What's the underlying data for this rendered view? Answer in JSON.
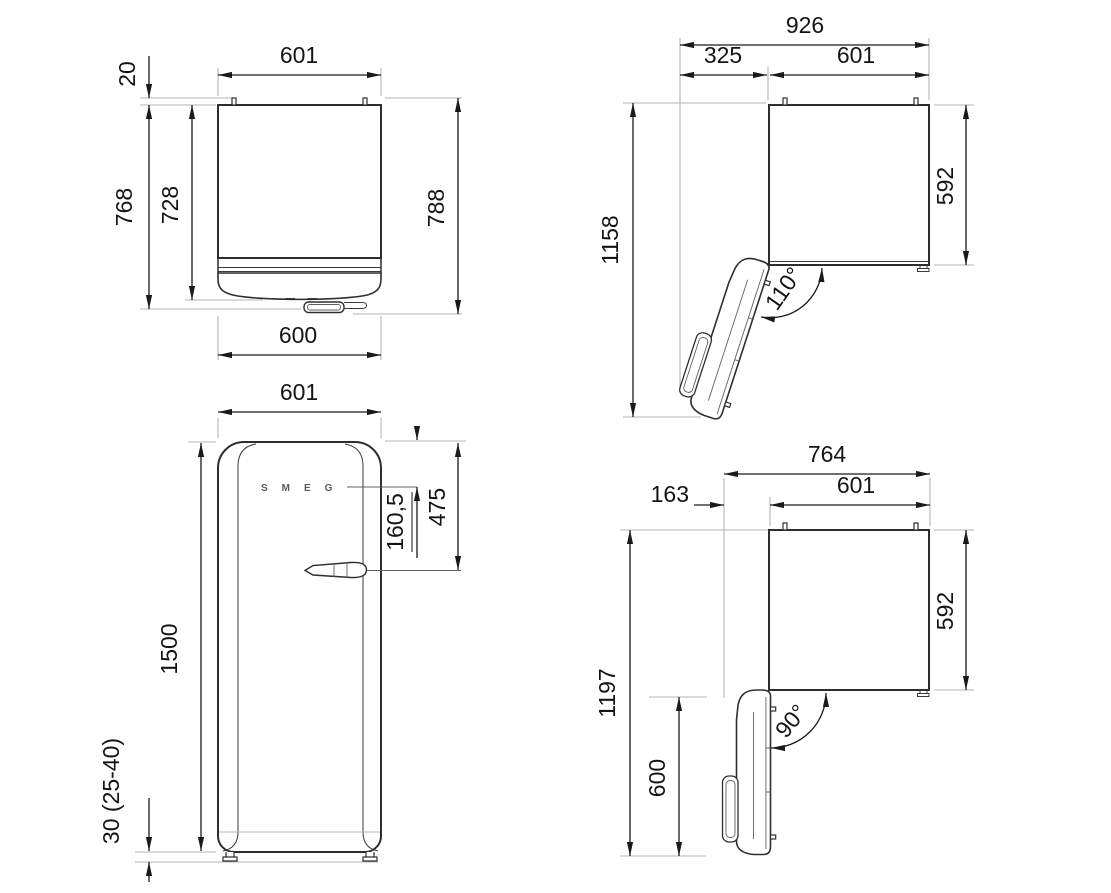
{
  "title": "refrigerator-dimension-drawing",
  "colors": {
    "dimension": "#1a1a1a",
    "extension": "#b4b4b4",
    "outline": "#2e2e2e",
    "detail": "#606060",
    "background": "#ffffff"
  },
  "views": {
    "top_closed": {
      "name": "Top view, door closed",
      "labels": {
        "body_width": "601",
        "wall_gap": "20",
        "depth_no_door": "728",
        "depth_with_door": "768",
        "depth_total": "788",
        "door_width": "600"
      }
    },
    "top_open_110": {
      "name": "Top view, door open 110 degrees",
      "labels": {
        "total_width": "926",
        "door_clearance": "325",
        "body_width": "601",
        "total_depth": "1158",
        "body_depth": "592",
        "angle": "110°"
      }
    },
    "front": {
      "name": "Front view",
      "labels": {
        "width": "601",
        "handle_offset": "475",
        "logo_offset": "160,5",
        "height": "1500",
        "feet": "30 (25-40)",
        "brand": "SMEG"
      }
    },
    "top_open_90": {
      "name": "Top view, door open 90 degrees",
      "labels": {
        "total_width": "764",
        "door_clearance": "163",
        "body_width": "601",
        "total_depth": "1197",
        "body_depth": "592",
        "door_depth": "600",
        "angle": "90°"
      }
    }
  }
}
